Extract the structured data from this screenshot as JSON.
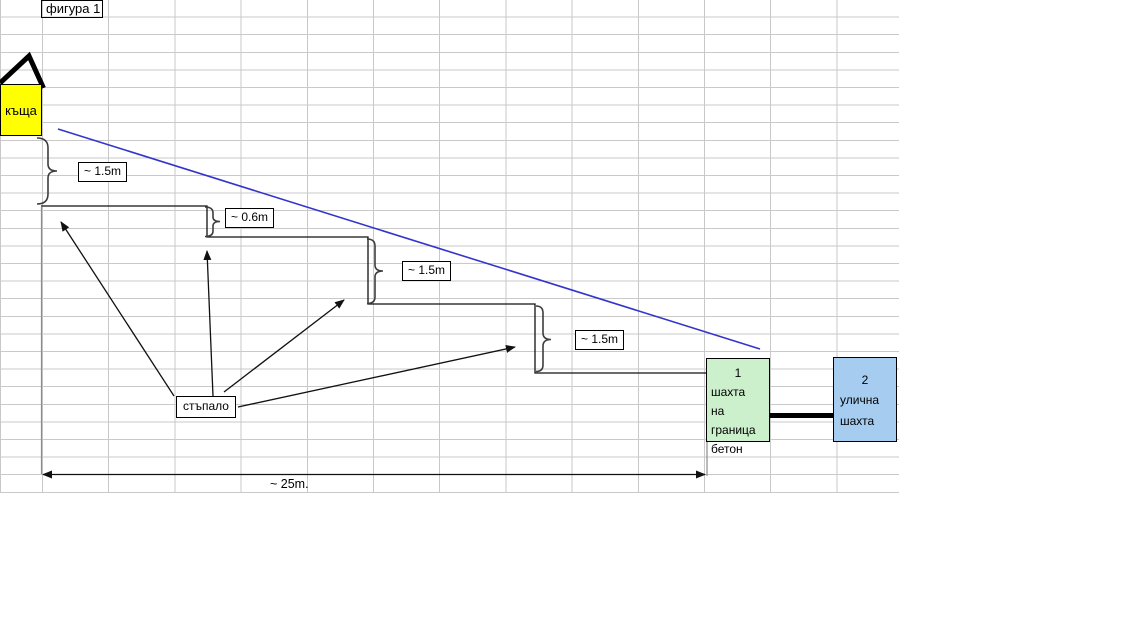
{
  "sheet": {
    "figure_label": "фигура 1"
  },
  "diagram": {
    "house": {
      "label": "къща"
    },
    "step_label": "стъпало",
    "measurements": [
      {
        "position": "house-to-step1",
        "label": "~ 1.5m"
      },
      {
        "position": "step1-to-step2",
        "label": "~ 0.6m"
      },
      {
        "position": "step2-to-step3",
        "label": "~ 1.5m"
      },
      {
        "position": "step3-to-step4",
        "label": "~ 1.5m"
      }
    ],
    "total_distance_label": "~ 25m.",
    "shaft_boundary": {
      "number": "1",
      "lines": [
        "шахта",
        "на граница",
        "бетон"
      ]
    },
    "shaft_street": {
      "number": "2",
      "lines": [
        "улична",
        "шахта"
      ]
    }
  },
  "colors": {
    "house-fill": "#ffff00",
    "boundary-shaft-fill": "#ccf0cc",
    "street-shaft-fill": "#a6cdf0",
    "slope-line": "#3434cc",
    "gridline": "#c9c9c9",
    "ink": "#000000"
  }
}
